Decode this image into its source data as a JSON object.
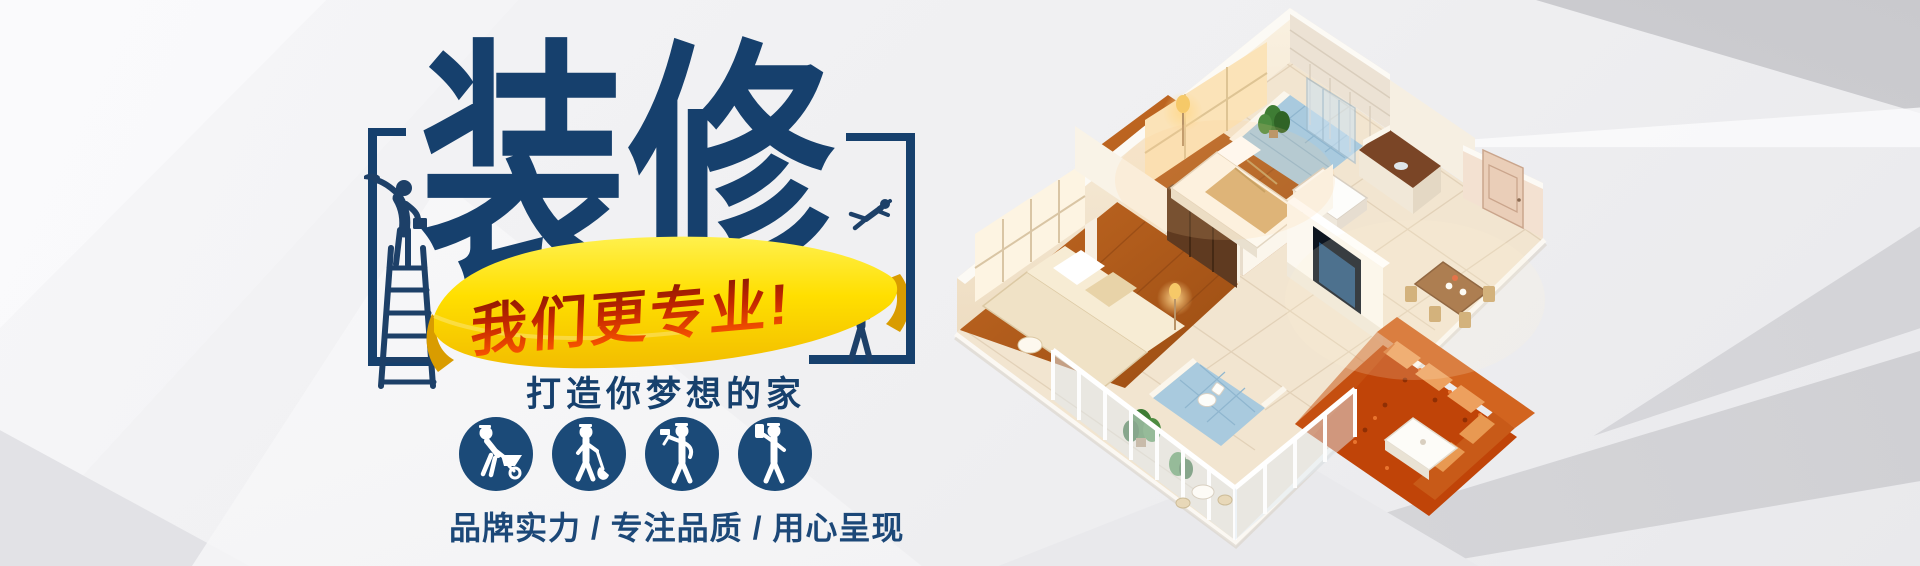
{
  "banner": {
    "title": "装修",
    "ribbon": {
      "text": "我们更专业!"
    },
    "subtitle": "打造你梦想的家",
    "tagline": "品牌实力 / 专注品质 / 用心呈现",
    "feature_icons": [
      {
        "icon": "worker-wheelbarrow-icon"
      },
      {
        "icon": "worker-shovel-icon"
      },
      {
        "icon": "worker-hammer-icon"
      },
      {
        "icon": "worker-paint-icon"
      }
    ],
    "decoration_icons": [
      {
        "icon": "painter-on-ladder-icon"
      },
      {
        "icon": "jumping-worker-icon"
      },
      {
        "icon": "worker-with-hammer-icon"
      }
    ],
    "colors": {
      "title_blue": "#16406D",
      "icon_circle_blue": "#1B4A78",
      "ribbon_yellow": "#FFE400",
      "ribbon_yellow_deep": "#F4C100",
      "ribbon_fold": "#D99C00",
      "ribbon_text_dark": "#7E1604",
      "ribbon_text_bright": "#FF5A00",
      "background_gray": "#EFEFF1"
    }
  },
  "illustration": {
    "icon": "isometric-apartment-3d-render"
  }
}
